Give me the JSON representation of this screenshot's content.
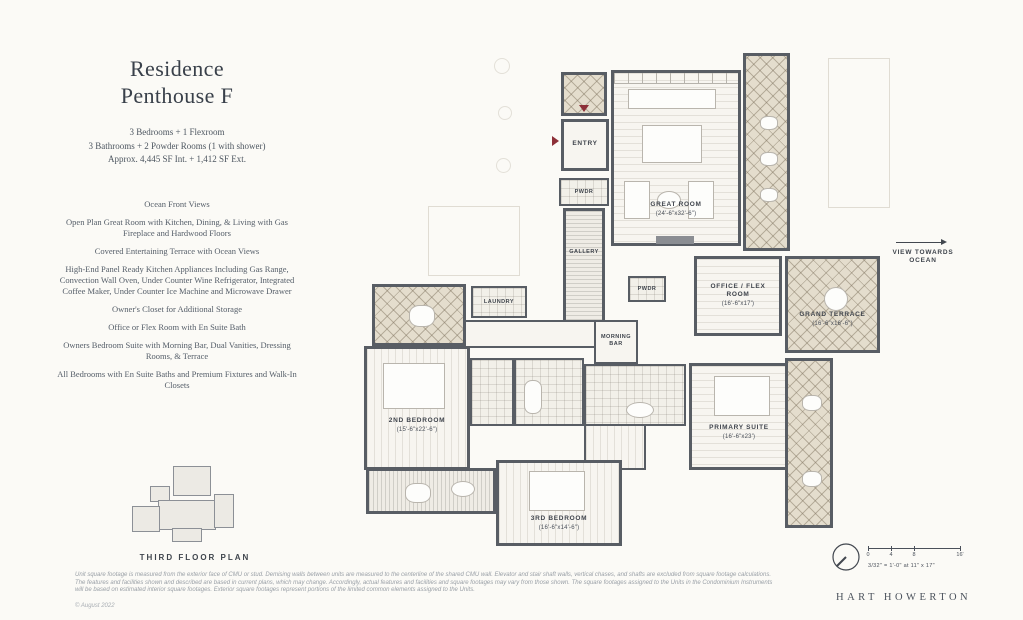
{
  "info_panel": {
    "title_line1": "Residence",
    "title_line2": "Penthouse F",
    "stats": [
      "3 Bedrooms + 1 Flexroom",
      "3 Bathrooms + 2 Powder Rooms (1 with shower)",
      "Approx. 4,445 SF Int. + 1,412 SF Ext."
    ],
    "features": [
      "Ocean Front Views",
      "Open Plan Great Room with Kitchen, Dining, & Living with Gas Fireplace and Hardwood Floors",
      "Covered Entertaining Terrace with Ocean Views",
      "High-End Panel Ready Kitchen Appliances Including Gas Range, Convection Wall Oven, Under Counter Wine Refrigerator, Integrated Coffee Maker, Under Counter Ice Machine and Microwave Drawer",
      "Owner's Closet for Additional Storage",
      "Office or Flex Room with En Suite Bath",
      "Owners Bedroom Suite with Morning Bar, Dual Vanities, Dressing Rooms, & Terrace",
      "All Bedrooms with En Suite Baths and Premium Fixtures and Walk-In Closets"
    ],
    "keyplan_label": "THIRD FLOOR PLAN"
  },
  "plan": {
    "rooms": {
      "entry": {
        "label": "ENTRY"
      },
      "powder_entry": {
        "label": "PWDR"
      },
      "gallery": {
        "label": "GALLERY"
      },
      "great_room": {
        "label": "GREAT ROOM",
        "dims": "(24'-6\"x32'-6\")"
      },
      "office_flex": {
        "label": "OFFICE / FLEX ROOM",
        "dims": "(16'-6\"x17')"
      },
      "grand_terrace": {
        "label": "GRAND TERRACE",
        "dims": "(16'-6\"x16'-6\")"
      },
      "powder_hall": {
        "label": "PWDR"
      },
      "morning_bar": {
        "label": "MORNING BAR"
      },
      "laundry": {
        "label": "LAUNDRY"
      },
      "second_bedroom": {
        "label": "2ND BEDROOM",
        "dims": "(15'-6\"x22'-6\")"
      },
      "third_bedroom": {
        "label": "3RD BEDROOM",
        "dims": "(16'-6\"x14'-6\")"
      },
      "primary_suite": {
        "label": "PRIMARY SUITE",
        "dims": "(16'-6\"x23')"
      }
    },
    "view_direction": "VIEW TOWARDS OCEAN"
  },
  "scale_bar": {
    "ticks": [
      "0",
      "4",
      "8",
      "16'"
    ],
    "note": "3/32\" = 1'-0\" at 11\" x 17\""
  },
  "footer": {
    "disclaimer": "Unit square footage is measured from the exterior face of CMU or stud. Demising walls between units are measured to the centerline of the shared CMU wall. Elevator and stair shaft walls, vertical chases, and shafts are excluded from square footage calculations. The features and facilities shown and described are based in current plans, which may change. Accordingly, actual features and facilities and square footages may vary from those shown. The square footages assigned to the Units in the Condominium Instruments will be based on estimated interior square footages. Exterior square footages represent portions of the limited common elements assigned to the Units.",
    "copyright": "© August 2022",
    "brand": "HART HOWERTON"
  },
  "colors": {
    "accent_red": "#8d3038",
    "wall": "#585d64"
  }
}
